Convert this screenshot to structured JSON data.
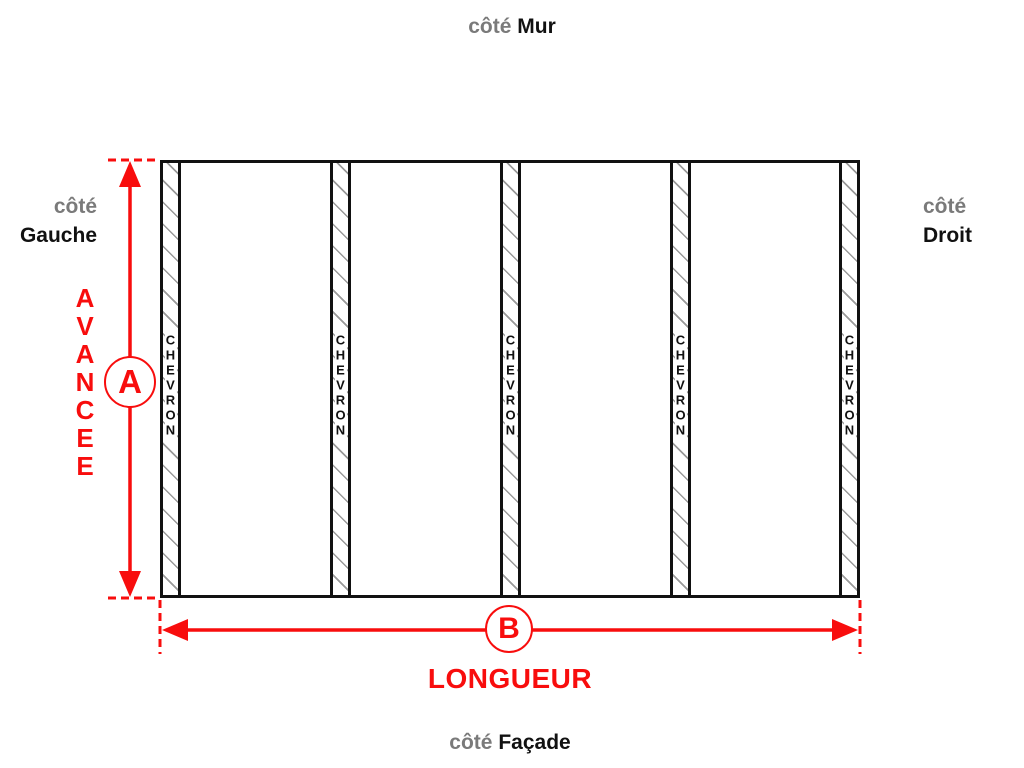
{
  "labels": {
    "top": {
      "prefix": "côté",
      "name": "Mur"
    },
    "left": {
      "prefix": "côté",
      "name": "Gauche"
    },
    "right": {
      "prefix": "côté",
      "name": "Droit"
    },
    "bottom": {
      "prefix": "côté",
      "name": "Façade"
    }
  },
  "dimensions": {
    "vertical": {
      "letter": "A",
      "label": "AVANCEE"
    },
    "horizontal": {
      "letter": "B",
      "label": "LONGUEUR"
    }
  },
  "chevrons": {
    "label": "CHEVRON",
    "count": 5
  },
  "colors": {
    "dimension_red": "#f80d0d",
    "muted_label_gray": "#7a7a7a",
    "outline_black": "#111111",
    "hatch_gray": "#9a9a9a",
    "background": "#ffffff"
  }
}
